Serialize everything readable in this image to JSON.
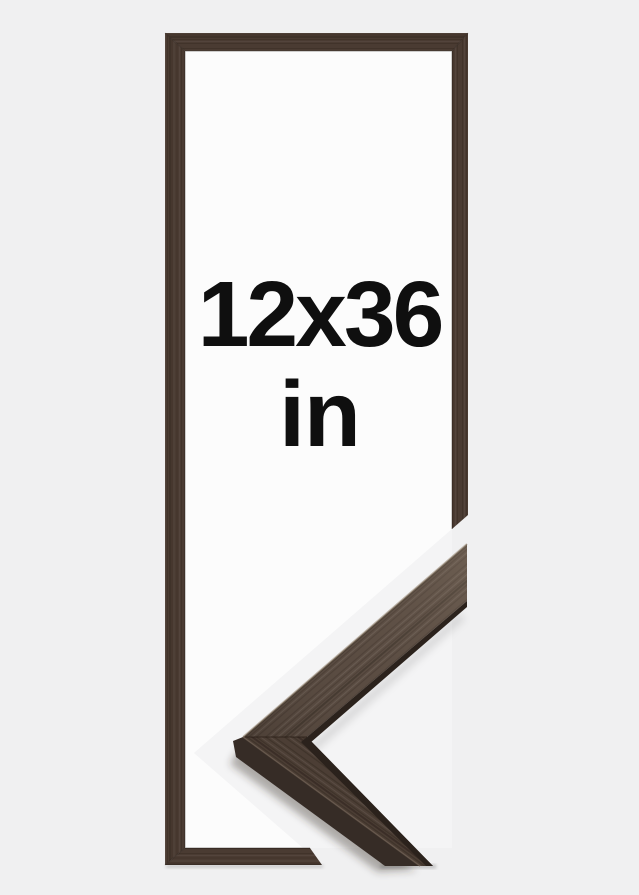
{
  "product_preview": {
    "size_label": "12x36",
    "unit_label": "in"
  },
  "colors": {
    "page_bg": "#f0f0f1",
    "detail_photo_bg": "#f4f4f5",
    "frame_interior": "#fcfcfc",
    "wood_frame": "#4a3b32",
    "wood_detail_top_arm": "#594b41",
    "wood_detail_bottom_arm": "#4c3e35",
    "wood_detail_front_face": "#362c26",
    "wood_edge_dark": "#2b221c",
    "text": "#0f0f0f"
  }
}
